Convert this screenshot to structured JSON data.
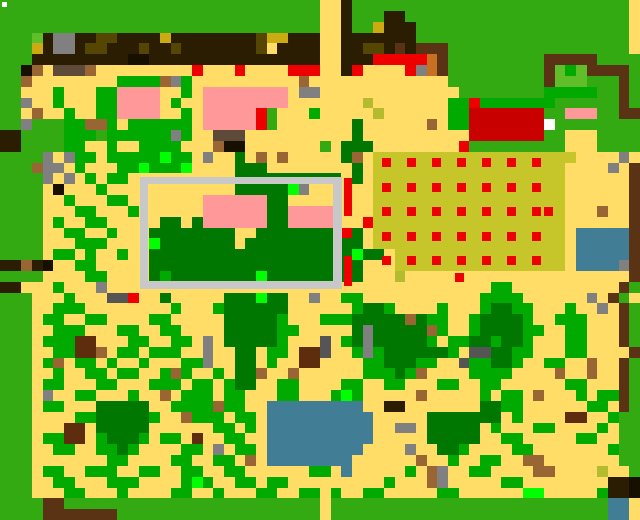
{
  "title": "pixel-farm-map",
  "map": {
    "width": 640,
    "height": 520,
    "cols": 60,
    "rows": 48,
    "palette": {
      "G": {
        "color": "#33AA11",
        "name": "grass"
      },
      "H": {
        "color": "#5FBE2A",
        "name": "light-grass"
      },
      "g": {
        "color": "#00AA00",
        "name": "vegetation"
      },
      "d": {
        "color": "#007700",
        "name": "tree-canopy"
      },
      "L": {
        "color": "#00FF00",
        "name": "bright-plant"
      },
      "S": {
        "color": "#FFDD66",
        "name": "sand"
      },
      "B": {
        "color": "#2A1D02",
        "name": "dark-structure"
      },
      "k": {
        "color": "#171000",
        "name": "black-brown"
      },
      "W": {
        "color": "#5A3315",
        "name": "wood-wall"
      },
      "w": {
        "color": "#996633",
        "name": "dirt"
      },
      "E": {
        "color": "#5E2D0E",
        "name": "soil-patch"
      },
      "n": {
        "color": "#5E4A38",
        "name": "taupe-rock"
      },
      "o": {
        "color": "#554703",
        "name": "dark-olive"
      },
      "M": {
        "color": "#CCAA11",
        "name": "gold"
      },
      "c": {
        "color": "#C6C62A",
        "name": "crop-field"
      },
      "Q": {
        "color": "#B5BB2E",
        "name": "young-crop"
      },
      "P": {
        "color": "#FF9999",
        "name": "pink-roof"
      },
      "R": {
        "color": "#EE0000",
        "name": "red-marker"
      },
      "C": {
        "color": "#C80000",
        "name": "red-roof"
      },
      "A": {
        "color": "#808080",
        "name": "rock"
      },
      "X": {
        "color": "#555555",
        "name": "dark-rock"
      },
      "F": {
        "color": "#C8C8C8",
        "name": "fence"
      },
      "U": {
        "color": "#417E96",
        "name": "water"
      },
      "Y": {
        "color": "#FFFFFF",
        "name": "white-marker"
      },
      "O": {
        "color": "#C87022",
        "name": "orange-crate"
      }
    },
    "grid": [
      "GGGGGGGGGGGGGGGGGGGGGGGGGGGGGGSSBGGGGGGGGGGGGGGGGGGGGGGGGGG",
      "GGGGGGGGGGGGGGGGGGGGGGGGGGGGGGSSBGGGBBGGGGGGGGGGGGGGGGGGGGG",
      "GGGGGGGGGGGGGGGGGGGGGGGGGGGGGGSSBGGMBBBGGGGGGGGGGGGGGGGGGGG",
      "GGGHBAABBooBBBBMBBBBBBBBoMMBBBSSBBBBBBBGGGGGGGGGGGGGGGGGGGG",
      "GGGMBAABooBBBoBBoBBBBBBBoSBBBBSSBBooBWBWWWGGGGGGGGGGGGGGGGG",
      "GGGBBBBBBBBBkkBBBBBBBBBBBBBBBBSSBBBRRRRROWGGGGGGGGGWWWWWGGGG",
      "GGkwSnnnwSSSSSSSSSRSSSRSSSSRRRSSBRSSSSRAOWGGGGGGGGGWHgHWWWWG",
      "GGwSSSSSSSSggggwAgSSSSSSSSSSwSSSSSSSSSSSSSGGGGGGGGGWHHHGGGWG",
      "GGSSSgSSSggPPPPSSgSPPPPPPPPSAASSSSSSSSSSSSSGGGGGGGGgggggGGWG",
      "GGASSgSSSggPPPPSgSSPPPPPPPPSSSSSSSQSSSSSSSggRgggggggGGGGGGWG",
      "GGSwSSgSSggPPPPSSgSPPPPPRGSSSgSSSSSQSSSSSSggCCCCCCCGGPPPGGWW",
      "GGAGGGggwwgSggggggSPPPPPRGSSSSSSSdSSSSSSwSggCCCCCCCYGGGGGGGG",
      "BBGGGGgggGggggggAgSSnnnSSSSSSSSSSdSSSSSSSSSSCCCCCCCGGSSSGGGG",
      "BBGGGGggSSgSSggggSSSwkkSSSSSSSGSdddSSSSSSSSRGGGGGGGGGSSSGGGG",
      "GGGGASAggSgggggLggSASSdSwSwSSSSSdwScccccccccccccccccccSSSSASWW",
      "GGGwAASgSSSggLgggLSSSSdddSSSSSSSSdSccccccccccccccccccSSSSASWG",
      "GGGGASASgSggSSSSSSSSSSddddddddddSdSccccccccccccccccccSSSSSSWG",
      "GGGGSkSSSgSSSSSSSSSSSSdddddLASSSSSSccccccccccccccccccSSSSSSWG",
      "GGGGSSgSSSggSSSSSSSPPPPPPddSSSSSSSSccccccccccccccccccSSSSSSWG",
      "GGGGSSSggSSSgSSSSSSPPPPPPddPPPPPSSSccccccccccccccccccSSSwSSWG",
      "GGGGSgSSggSSSSSddSdPPPPPPddPPPPPSSRccccccccccccccccccSSSSSSWG",
      "GGGGSSggSSgSSSddddddddSSddddddddRdSccccccccccccccccccSUUUUUWG",
      "GGGGSSSgggSSSSLdddddddSdddddddddddSccccccccccccccccccSUUUUUWG",
      "GGGGSggSgSSgSSdddddddddddddddddddLddSccccccccccccccccSUUUUUWG",
      "BBwBkSSggSSSSSddddddddddddddddddddSSSccccccccccccccccSUUUUAWG",
      "GGGGSSSSggSSSSdgddddddddLdddddddddSSSQSSSSSSSSSSSSSSSSSSSSSWG",
      "BBSSSgSSSASSSSSSSSSSSSSSSSSSSSSSSSSSSSSSSSSSSSggSSSSSSSSSSWG",
      "GGGSSSgSSSXXRSSdSSSSSdddLddSSASSggSSSSSSSSSSSggggSSSSSSASWG",
      "GGGSSgggSSSSSSSSgSSSgddddddSSSSSSgddgSSSSgSSSgddggSSSgSSASWG",
      "GGGSggSSggSSSSggSSSSSdddddgSSSgggdddddwdggSSgddddgSSgggSSSWG",
      "GGGSSgggSSSggSSggSSSSdddddggSSSSSdAdddddwgSSgddddggSSggSSSWG",
      "GGGSgggEESSSggSSggSASdddddgSSSXSgdAdddddgSggddgddgSSSggSSSWG",
      "GGGSSggEEwSggSgggSSASSddSggSEEXSSgAgddddddgSXXddggSSSggSSSSWG",
      "GGGSgwSggSgSSgSSSggASSddSgSSEESSSSggdddggSSXggddgSSggSSwSSWG",
      "GGGSSgSSggSggSSgwgSSgSddwSSwSSSSSSgggdgwSSSSggggSSSSwSSwSSWG",
      "GGGSggSSSggSSSgggSggSgddSSggSSSSggSSggSSSggSSggSSSSSSggSSSWG",
      "GGGSASSggSSSgSSwSgggSggSSSggSSSgLgSSSSSwSSSSSgSggSwSSSgSggWG",
      "GGGSggSSSdddddSSggggwggSSUUUUUUUUUSSBBSSSSSSSddggSSSSSSggSWG",
      "GGGSSSSggdddddgSSwgggSggSUUUUUUUUUUSSSSSdddddddSgSSSSEESSgGG",
      "GGGSSSEESdddddSSSSSSggSgSUUUUUUUUUUSSAASdddddSgSSSggSSSSgSGG",
      "GGGSggEESgdddgSggSESSggSSUUUUUUUUUUSSSSSdddddSSggSSSSSggSSGG",
      "GGGSSggSSggdgSSSSggSASggSUUUUUUUUUSSSSASSddgSSSSggSSSSSSSgGG",
      "GGGSSSSSSSggSSSSggSSggSwSUUUUUUUUSSSSSSwSSgSSggSSwwSSSSSSSGG",
      "GGGSggSSgggSSggSSggSSggSSSSSSggSUSSSSSgSwASSggSSSSwwSSSSQSSGH",
      "GGGSSggSSSgggSSSSgLgSSggSggSSSSSSSSSgSSSwASSSSSggSSSSSSSSBBkB",
      "GGGSSSggSSSgSSSSggSSgSSSggSSggSgSSggSSSSSggSSSSSSLLSSSSSgBBkB",
      "GGGGWWGGGGGGGGGGGGGGGGGGGGGGGGSGGGGGGGGGGGGGGGGGGGGGGGGGGUUSB",
      "GGGGWWWWWWWGGGGGGGGGGGGGGGGGGGSGGGGGGGGGGGGGGGGGGGGGGGGGGUUSB"
    ],
    "overlays": [
      {
        "name": "spawn-dot",
        "x": 2,
        "y": 2,
        "w": 5,
        "h": 5,
        "color": "#FFFFFF"
      },
      {
        "name": "paddock-fence-top",
        "x": 140,
        "y": 177,
        "w": 202,
        "h": 7,
        "color": "#C8C8C8"
      },
      {
        "name": "paddock-fence-bottom",
        "x": 140,
        "y": 281,
        "w": 202,
        "h": 8,
        "color": "#C8C8C8"
      },
      {
        "name": "paddock-fence-left",
        "x": 140,
        "y": 177,
        "w": 8,
        "h": 112,
        "color": "#C8C8C8"
      },
      {
        "name": "paddock-fence-right",
        "x": 333,
        "y": 177,
        "w": 9,
        "h": 112,
        "color": "#C8C8C8"
      },
      {
        "name": "red-strip-upper",
        "x": 344,
        "y": 178,
        "w": 8,
        "h": 38,
        "color": "#EE0000"
      },
      {
        "name": "red-strip-lower",
        "x": 344,
        "y": 256,
        "w": 8,
        "h": 30,
        "color": "#EE0000"
      }
    ],
    "crop_dots": {
      "name": "crop-field-dots",
      "start_x": 382,
      "start_y": 158,
      "cols": 7,
      "rows": 5,
      "pitch_x": 25,
      "pitch_y": 24.5,
      "size": 9,
      "color": "#EE0000",
      "extra": [
        [
          544,
          207
        ],
        [
          455,
          273
        ]
      ]
    }
  }
}
